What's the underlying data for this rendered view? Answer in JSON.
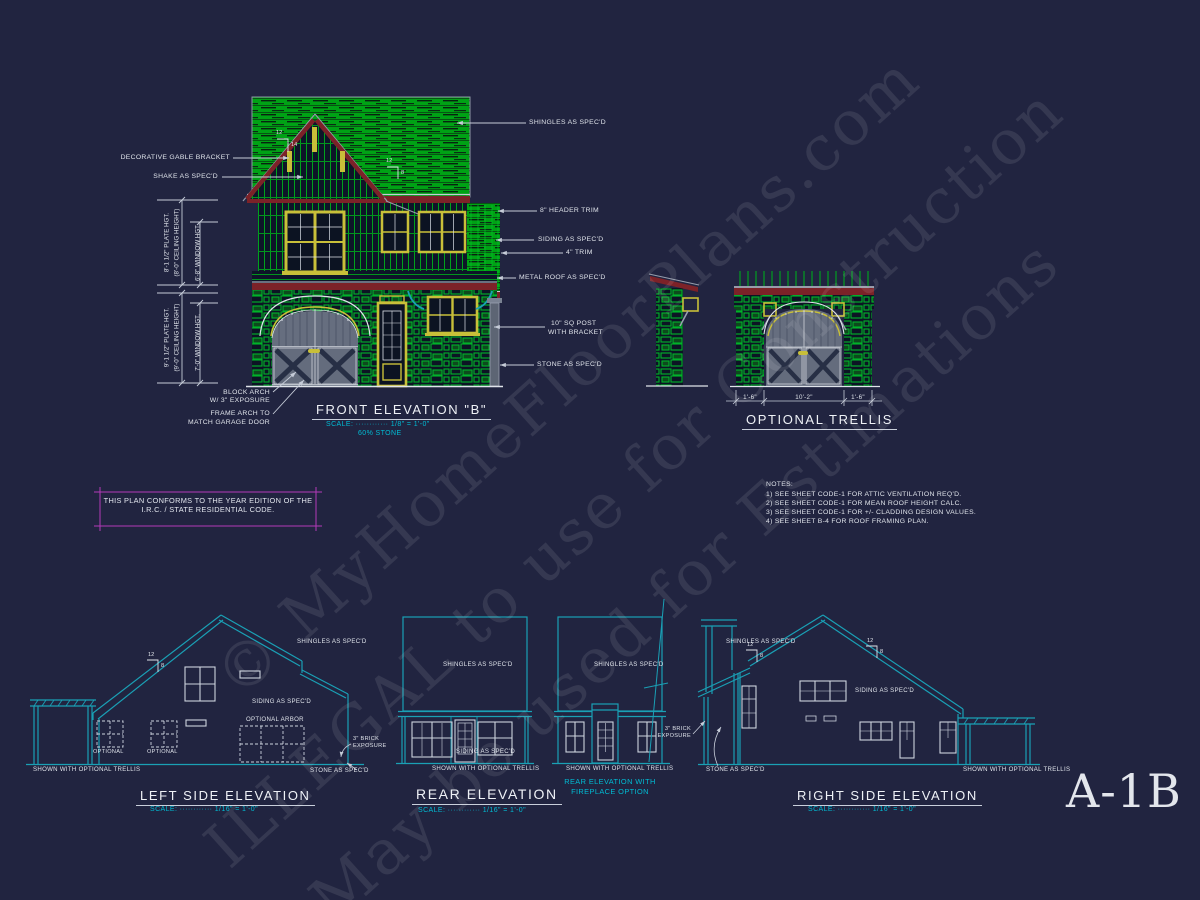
{
  "colors": {
    "background": "#212440",
    "cyan": "#00bcd4",
    "teal": "#1aa0b5",
    "green": "#00a81e",
    "maroon": "#7c2228",
    "yellow": "#c8bf39",
    "magenta": "#b23ab8",
    "white": "#e2e6ee"
  },
  "sheet": {
    "number": "A-1B"
  },
  "watermark": {
    "line1": "© MyHomeFloorPlans.com",
    "line2": "ILLEGAL to use for Construction",
    "line3": "May be used for Estimations"
  },
  "conform_box": {
    "line1": "THIS PLAN CONFORMS TO THE YEAR EDITION OF THE",
    "line2": "I.R.C. / STATE RESIDENTIAL CODE."
  },
  "notes": {
    "heading": "NOTES:",
    "item1": "1)  SEE SHEET CODE-1 FOR ATTIC VENTILATION REQ'D.",
    "item2": "2)  SEE SHEET CODE-1 FOR MEAN ROOF HEIGHT CALC.",
    "item3": "3)  SEE SHEET CODE-1 FOR +/- CLADDING DESIGN VALUES.",
    "item4": "4)  SEE SHEET B-4 FOR ROOF FRAMING PLAN."
  },
  "front": {
    "title": "FRONT ELEVATION \"B\"",
    "scale": "SCALE: ············ 1/8\" = 1'-0\"",
    "stone_pct": "60% STONE",
    "lbl_bracket": "DECORATIVE GABLE BRACKET",
    "lbl_shake": "SHAKE AS SPEC'D",
    "lbl_shingles": "SHINGLES AS SPEC'D",
    "lbl_header": "8\" HEADER TRIM",
    "lbl_siding": "SIDING AS SPEC'D",
    "lbl_trim": "4\" TRIM",
    "lbl_metal": "METAL ROOF AS SPEC'D",
    "lbl_post1": "10\" SQ POST",
    "lbl_post2": "WITH BRACKET",
    "lbl_stone": "STONE AS SPEC'D",
    "lbl_block1": "BLOCK ARCH",
    "lbl_block2": "W/ 3\" EXPOSURE",
    "lbl_frame1": "FRAME ARCH TO",
    "lbl_frame2": "MATCH GARAGE DOOR",
    "dim_plate8": "8'-1 1/2\" PLATE HGT.",
    "dim_ceil8": "(8'-0\" CEILING HEIGHT)",
    "dim_win68": "6'-8\" WINDOW HGT.",
    "dim_plate9": "9'-1 1/2\" PLATE HGT.",
    "dim_ceil9": "(9'-0\" CEILING HEIGHT)",
    "dim_win70": "7'-0\" WINDOW HGT.",
    "pitch12": "12",
    "pitch14": "14",
    "pitch8": "8"
  },
  "trellis": {
    "title": "OPTIONAL TRELLIS",
    "dim_left": "1'-6\"",
    "dim_mid": "10'-2\"",
    "dim_right": "1'-6\""
  },
  "left_elev": {
    "title": "LEFT SIDE ELEVATION",
    "scale": "SCALE: ············ 1/16\" = 1'-0\"",
    "lbl_shingles": "SHINGLES AS SPEC'D",
    "lbl_siding": "SIDING AS SPEC'D",
    "lbl_arbor": "OPTIONAL ARBOR",
    "lbl_opt1": "OPTIONAL",
    "lbl_opt2": "OPTIONAL",
    "lbl_brick1": "3\" BRICK",
    "lbl_brick2": "EXPOSURE",
    "lbl_shown": "SHOWN WITH OPTIONAL TRELLIS",
    "lbl_stone": "STONE AS SPEC'D",
    "pitch12": "12",
    "pitch8": "8"
  },
  "rear_elev": {
    "title": "REAR ELEVATION",
    "scale": "SCALE: ············ 1/16\" = 1'-0\"",
    "lbl_shingles": "SHINGLES AS SPEC'D",
    "lbl_siding": "SIDING AS SPEC'D",
    "lbl_shown": "SHOWN WITH OPTIONAL TRELLIS"
  },
  "rear_fp_elev": {
    "title1": "REAR ELEVATION WITH",
    "title2": "FIREPLACE OPTION",
    "lbl_shingles": "SHINGLES AS SPEC'D",
    "lbl_shown": "SHOWN WITH OPTIONAL TRELLIS"
  },
  "right_elev": {
    "title": "RIGHT SIDE ELEVATION",
    "scale": "SCALE: ············ 1/16\" = 1'-0\"",
    "lbl_shingles": "SHINGLES AS SPEC'D",
    "lbl_siding": "SIDING AS SPEC'D",
    "lbl_brick1": "3\" BRICK",
    "lbl_brick2": "EXPOSURE",
    "lbl_stone": "STONE AS SPEC'D",
    "lbl_shown": "SHOWN WITH OPTIONAL TRELLIS",
    "pitch12": "12",
    "pitch8": "8"
  }
}
